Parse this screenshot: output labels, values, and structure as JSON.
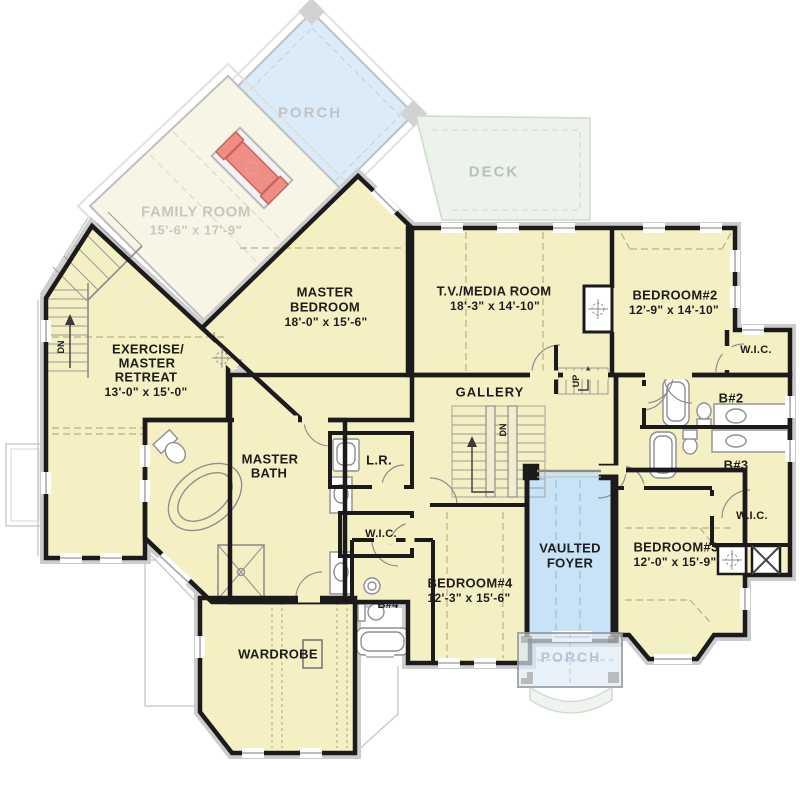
{
  "colors": {
    "floor": "#F5EFC4",
    "faded_floor": "#F7F4E3",
    "wall": "#1B1B1B",
    "porch_blue": "#D7E9F7",
    "foyer_blue": "#C8E2F6",
    "deck_green": "#E9F2E9",
    "fireplace_red": "#EF8279"
  },
  "labels": {
    "porch_top": "PORCH",
    "family_room": {
      "name": "FAMILY ROOM",
      "dims": "15'-6\" x 17'-9\""
    },
    "deck": "DECK",
    "master_bedroom": {
      "line1": "MASTER",
      "line2": "BEDROOM",
      "dims": "18'-0\" x 15'-6\""
    },
    "tv_media_room": {
      "name": "T.V./MEDIA ROOM",
      "dims": "18'-3\" x 14'-10\""
    },
    "bedroom2": {
      "name": "BEDROOM#2",
      "dims": "12'-9\" x 14'-10\""
    },
    "exercise_retreat": {
      "line1": "EXERCISE/",
      "line2": "MASTER",
      "line3": "RETREAT",
      "dims": "13'-0\" x 15'-0\""
    },
    "gallery": "GALLERY",
    "master_bath": {
      "line1": "MASTER",
      "line2": "BATH"
    },
    "laundry": "L.R.",
    "wic_top_right": "W.I.C.",
    "wic_mid": "W.I.C.",
    "wic_lower_right": "W.I.C.",
    "bath2": "B#2",
    "bath3": "B#3",
    "bath4": "B#4",
    "vaulted_foyer": {
      "line1": "VAULTED",
      "line2": "FOYER"
    },
    "bedroom3": {
      "name": "BEDROOM#3",
      "dims": "12'-0\" x 15'-9\""
    },
    "bedroom4": {
      "name": "BEDROOM#4",
      "dims": "12'-3\" x 15'-6\""
    },
    "wardrobe": "WARDROBE",
    "porch_bottom": "PORCH",
    "stairs": {
      "down_left": "DN",
      "down_center": "DN",
      "up_center": "UP"
    }
  }
}
